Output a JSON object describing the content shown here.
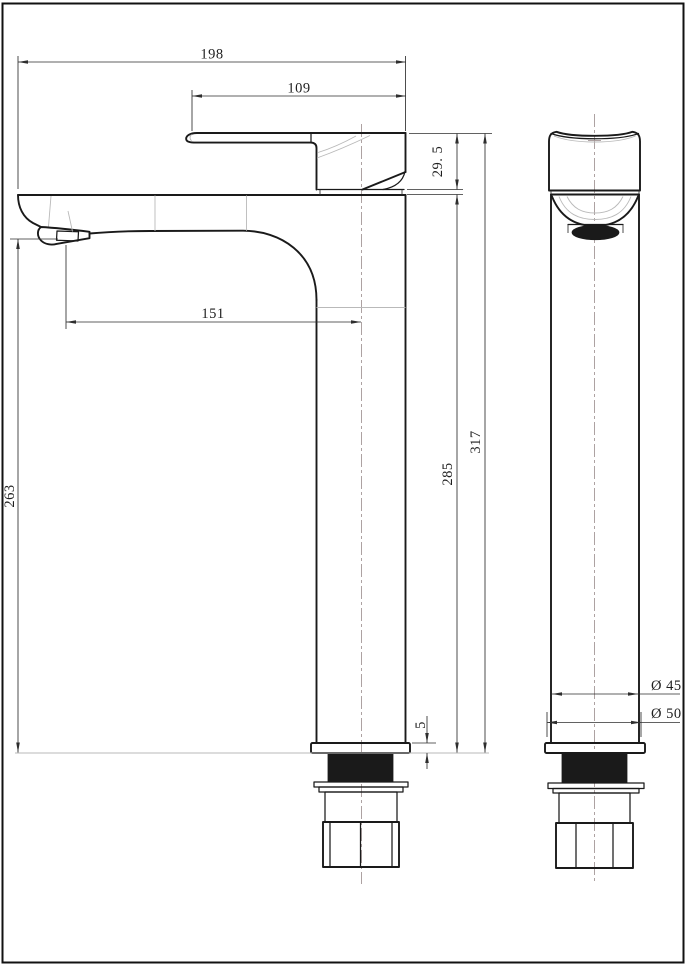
{
  "drawing": {
    "subject": "tall single-lever basin mixer tap, two-view dimensioned technical drawing",
    "units": "mm",
    "dimensions": {
      "overall_length": "198",
      "handle_length": "109",
      "handle_height": "29. 5",
      "overall_height": "317",
      "deck_to_base_height": "285",
      "spout_outlet_height": "263",
      "spout_reach": "151",
      "base_flange_thickness": "5",
      "body_diameter": "Ø 45",
      "base_flange_diameter": "Ø 50"
    },
    "colors": {
      "line": "#1a1a1a",
      "thin": "#2e2e2e",
      "faint": "#b9b9b9",
      "centerline": "#a59898",
      "background": "#ffffff"
    }
  }
}
